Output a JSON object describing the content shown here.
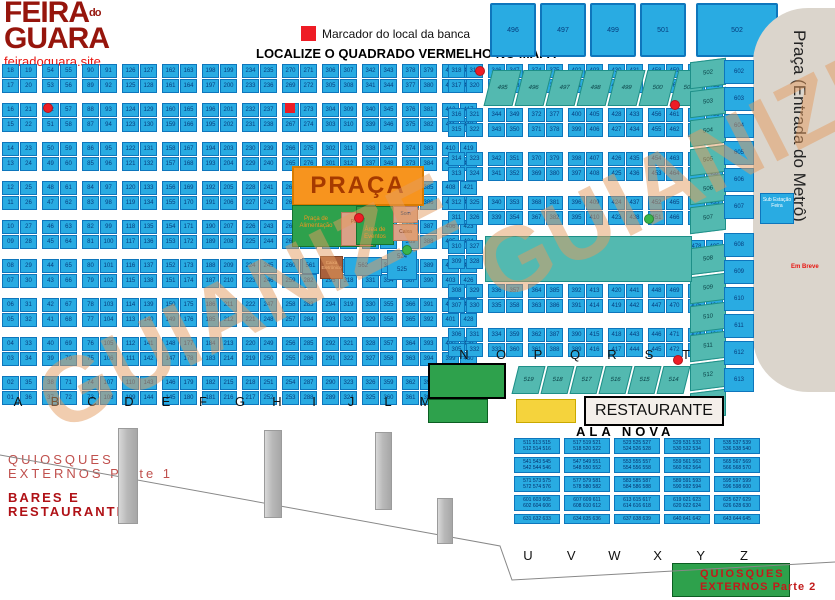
{
  "logo": {
    "line1": "FEIRA",
    "mid": "do",
    "line2": "GUARA",
    "site": "feiradoguara.site"
  },
  "legend": {
    "marker_label": "Marcador do local da banca",
    "headline": "LOCALIZE O QUADRADO VERMELHO NO MAPA"
  },
  "watermark": {
    "text": "GUIANIZE"
  },
  "colors": {
    "accent_red": "#EE1C25",
    "cell_blue": "#29ABE2",
    "teal": "#53B9B0",
    "orange": "#F7941E",
    "green": "#2EA14C",
    "yellow": "#F5D33C",
    "logo_red": "#96150C",
    "metro_gray": "#DBD5CC"
  },
  "top_boxes": [
    "496",
    "497",
    "499",
    "501",
    "502"
  ],
  "left_grid": {
    "columns": [
      {
        "letter": "A",
        "left": [
          18,
          17,
          16,
          15,
          14,
          13,
          12,
          11,
          10,
          9,
          8,
          7,
          6,
          5,
          4,
          3,
          2,
          1
        ],
        "right": [
          19,
          20,
          21,
          22,
          23,
          24,
          25,
          26,
          27,
          28,
          29,
          30,
          31,
          32,
          33,
          34,
          35,
          36
        ]
      },
      {
        "letter": "B",
        "left": [
          54,
          53,
          52,
          51,
          50,
          49,
          48,
          47,
          46,
          45,
          44,
          43,
          42,
          41,
          40,
          39,
          38,
          37
        ],
        "right": [
          55,
          56,
          57,
          58,
          59,
          60,
          61,
          62,
          63,
          64,
          65,
          66,
          67,
          68,
          69,
          70,
          71,
          72
        ]
      },
      {
        "letter": "C",
        "left": [
          90,
          89,
          88,
          87,
          86,
          85,
          84,
          83,
          82,
          81,
          80,
          79,
          78,
          77,
          76,
          75,
          74,
          73
        ],
        "right": [
          91,
          92,
          93,
          94,
          95,
          96,
          97,
          98,
          99,
          100,
          101,
          102,
          103,
          104,
          105,
          106,
          107,
          108
        ]
      },
      {
        "letter": "D",
        "left": [
          126,
          125,
          124,
          123,
          122,
          121,
          120,
          119,
          118,
          117,
          116,
          115,
          114,
          113,
          112,
          111,
          110,
          109
        ],
        "right": [
          127,
          128,
          129,
          130,
          131,
          132,
          133,
          134,
          135,
          136,
          137,
          138,
          139,
          140,
          141,
          142,
          143,
          144
        ]
      },
      {
        "letter": "E",
        "left": [
          162,
          161,
          160,
          159,
          158,
          157,
          156,
          155,
          154,
          153,
          152,
          151,
          150,
          149,
          148,
          147,
          146,
          145
        ],
        "right": [
          163,
          164,
          165,
          166,
          167,
          168,
          169,
          170,
          171,
          172,
          173,
          174,
          175,
          176,
          177,
          178,
          179,
          180
        ]
      },
      {
        "letter": "F",
        "left": [
          198,
          197,
          196,
          195,
          194,
          193,
          192,
          191,
          190,
          189,
          188,
          187,
          186,
          185,
          184,
          183,
          182,
          181
        ],
        "right": [
          199,
          200,
          201,
          202,
          203,
          204,
          205,
          206,
          207,
          208,
          209,
          210,
          211,
          212,
          213,
          214,
          215,
          216
        ]
      },
      {
        "letter": "G",
        "left": [
          234,
          233,
          232,
          231,
          230,
          229,
          228,
          227,
          226,
          225,
          224,
          223,
          222,
          221,
          220,
          219,
          218,
          217
        ],
        "right": [
          235,
          236,
          237,
          238,
          239,
          240,
          241,
          242,
          243,
          244,
          245,
          246,
          247,
          248,
          249,
          250,
          251,
          252
        ]
      },
      {
        "letter": "H",
        "left": [
          270,
          269,
          268,
          267,
          266,
          265,
          264,
          263,
          262,
          261,
          260,
          259,
          258,
          257,
          256,
          255,
          254,
          253
        ],
        "right": [
          271,
          272,
          273,
          274,
          275,
          276,
          277,
          278,
          279,
          280,
          281,
          282,
          283,
          284,
          285,
          286,
          287,
          288
        ]
      },
      {
        "letter": "I",
        "left": [
          306,
          305,
          304,
          303,
          302,
          301,
          300,
          299,
          298,
          297,
          296,
          295,
          294,
          293,
          292,
          291,
          290,
          289
        ],
        "right": [
          307,
          308,
          309,
          310,
          311,
          312,
          313,
          314,
          315,
          316,
          317,
          318,
          319,
          320,
          321,
          322,
          323,
          324
        ]
      },
      {
        "letter": "J",
        "left": [
          342,
          341,
          340,
          339,
          338,
          337,
          336,
          335,
          334,
          333,
          332,
          331,
          330,
          329,
          328,
          327,
          326,
          325
        ],
        "right": [
          343,
          344,
          345,
          346,
          347,
          348,
          349,
          350,
          351,
          352,
          353,
          354,
          355,
          356,
          357,
          358,
          359,
          360
        ]
      },
      {
        "letter": "L",
        "left": [
          378,
          377,
          376,
          375,
          374,
          373,
          372,
          371,
          370,
          369,
          368,
          367,
          366,
          365,
          364,
          363,
          362,
          361
        ],
        "right": [
          379,
          380,
          381,
          382,
          383,
          384,
          385,
          386,
          387,
          388,
          389,
          390,
          391,
          392,
          393,
          394,
          395,
          396
        ]
      },
      {
        "letter": "M",
        "left": [
          414,
          413,
          412,
          411,
          410,
          409,
          408,
          407,
          406,
          405,
          404,
          403,
          402,
          401,
          400,
          399,
          398,
          397
        ],
        "right": [
          415,
          416,
          417,
          418,
          419,
          420,
          421,
          422,
          423,
          424,
          425,
          426,
          427,
          428,
          429,
          430,
          431,
          432
        ]
      }
    ]
  },
  "right_grid": {
    "columns": [
      {
        "letter": "N",
        "left": [
          318,
          317,
          316,
          315,
          314,
          313,
          312,
          311,
          310,
          309,
          308,
          307,
          306,
          305
        ],
        "right": [
          319,
          320,
          321,
          322,
          323,
          324,
          325,
          326,
          327,
          328,
          329,
          330,
          331,
          332
        ]
      },
      {
        "letter": "O",
        "left": [
          346,
          345,
          344,
          343,
          342,
          341,
          340,
          339,
          338,
          337,
          336,
          335,
          334,
          333
        ],
        "right": [
          347,
          348,
          349,
          350,
          351,
          352,
          353,
          354,
          355,
          356,
          357,
          358,
          359,
          360
        ]
      },
      {
        "letter": "P",
        "left": [
          374,
          373,
          372,
          371,
          370,
          369,
          368,
          367,
          366,
          365,
          364,
          363,
          362,
          361
        ],
        "right": [
          375,
          376,
          377,
          378,
          379,
          380,
          381,
          382,
          383,
          384,
          385,
          386,
          387,
          388
        ]
      },
      {
        "letter": "Q",
        "left": [
          402,
          401,
          400,
          399,
          398,
          397,
          396,
          395,
          394,
          393,
          392,
          391,
          390,
          389
        ],
        "right": [
          403,
          404,
          405,
          406,
          407,
          408,
          409,
          410,
          411,
          412,
          413,
          414,
          415,
          416
        ]
      },
      {
        "letter": "R",
        "left": [
          430,
          429,
          428,
          427,
          426,
          425,
          424,
          423,
          422,
          421,
          420,
          419,
          418,
          417
        ],
        "right": [
          431,
          432,
          433,
          434,
          435,
          436,
          437,
          438,
          439,
          440,
          441,
          442,
          443,
          444
        ]
      },
      {
        "letter": "S",
        "left": [
          458,
          457,
          456,
          455,
          454,
          453,
          452,
          451,
          450,
          449,
          448,
          447,
          446,
          445
        ],
        "right": [
          459,
          460,
          461,
          462,
          463,
          464,
          465,
          466,
          467,
          468,
          469,
          470,
          471,
          472
        ]
      },
      {
        "letter": "T",
        "left": [
          486,
          485,
          484,
          483,
          482,
          481,
          480,
          479,
          478,
          477,
          476,
          475,
          474,
          473
        ],
        "right": [
          487,
          488,
          489,
          490,
          491,
          492,
          493,
          494,
          495,
          496,
          497,
          498,
          499,
          500
        ]
      }
    ]
  },
  "diag_top_strip": [
    "495",
    "496",
    "497",
    "498",
    "499",
    "500",
    "501"
  ],
  "diag_bottom_strip": [
    "519",
    "518",
    "517",
    "516",
    "515",
    "514"
  ],
  "side_teal_column": [
    "502",
    "503",
    "504",
    "505",
    "506",
    "507",
    "508",
    "509",
    "510",
    "511",
    "512",
    "513"
  ],
  "side_blue_column": [
    "602",
    "603",
    "604",
    "605",
    "606",
    "607",
    "608",
    "609",
    "610",
    "611",
    "612",
    "613"
  ],
  "praca": {
    "title": "PRAÇA",
    "food_court": "Praça de Alimentação",
    "stage": "Palco",
    "events": "Área de Eventos",
    "sound": "Som",
    "cash": "Caixa",
    "atm": "Caixa Eletrônico",
    "cell_a": "561",
    "cell_b": "562",
    "cell_c": "524",
    "cell_d": "525"
  },
  "metro": {
    "label": "Praça (Entrada do Metrô)",
    "soon": "Em Breve",
    "substation": "Sub Estação Feira"
  },
  "sections": {
    "restaurante": "RESTAURANTE",
    "ala_nova": "ALA NOVA",
    "quiosques1_line1": "QUIOSQUES",
    "quiosques1_line2": "EXTERNOS Parte 1",
    "bares_line1": "BARES E",
    "bares_line2": "RESTAURANTES",
    "quiosques2_line1": "QUIOSQUES",
    "quiosques2_line2": "EXTERNOS Parte 2"
  },
  "ala_nova": {
    "rows": [
      [
        [
          511,
          512,
          513,
          514,
          515,
          516
        ],
        [
          517,
          518,
          519,
          520,
          521,
          522
        ],
        [
          523,
          524,
          525,
          526,
          527,
          528
        ],
        [
          529,
          530,
          531,
          532,
          533,
          534
        ],
        [
          535,
          536,
          537,
          538,
          539,
          540
        ]
      ],
      [
        [
          541,
          542,
          543,
          544,
          545,
          546
        ],
        [
          547,
          548,
          549,
          550,
          551,
          552
        ],
        [
          553,
          554,
          555,
          556,
          557,
          558
        ],
        [
          559,
          560,
          561,
          562,
          563,
          564
        ],
        [
          565,
          566,
          567,
          568,
          569,
          570
        ]
      ],
      [
        [
          571,
          572,
          573,
          574,
          575,
          576
        ],
        [
          577,
          578,
          579,
          580,
          581,
          582
        ],
        [
          583,
          584,
          585,
          586,
          587,
          588
        ],
        [
          589,
          590,
          591,
          592,
          593,
          594
        ],
        [
          595,
          596,
          597,
          598,
          599,
          600
        ]
      ],
      [
        [
          601,
          602,
          603,
          604,
          605,
          606
        ],
        [
          607,
          608,
          609,
          610,
          611,
          612
        ],
        [
          613,
          614,
          615,
          616,
          617,
          618
        ],
        [
          619,
          620,
          621,
          622,
          623,
          624
        ],
        [
          625,
          626,
          627,
          628,
          629,
          630
        ]
      ],
      [
        [
          631,
          632,
          633
        ],
        [
          634,
          635,
          636
        ],
        [
          637,
          638,
          639
        ],
        [
          640,
          641,
          642
        ],
        [
          643,
          644,
          645
        ]
      ]
    ]
  },
  "letters_left": [
    "A",
    "B",
    "C",
    "D",
    "E",
    "F",
    "G",
    "H",
    "I",
    "J",
    "L",
    "M"
  ],
  "letters_mid": [
    "N",
    "O",
    "P",
    "Q",
    "R",
    "S",
    "T"
  ],
  "letters_bottom": [
    "U",
    "V",
    "W",
    "X",
    "Y",
    "Z"
  ],
  "markers": [
    {
      "x": 43,
      "y": 103,
      "color": "#EE1C25"
    },
    {
      "x": 475,
      "y": 66,
      "color": "#EE1C25"
    },
    {
      "x": 670,
      "y": 100,
      "color": "#EE1C25"
    },
    {
      "x": 673,
      "y": 355,
      "color": "#EE1C25"
    },
    {
      "x": 354,
      "y": 213,
      "color": "#EE1C25"
    },
    {
      "x": 402,
      "y": 245,
      "color": "#39B54A"
    },
    {
      "x": 644,
      "y": 214,
      "color": "#39B54A"
    }
  ],
  "pillars": [
    {
      "x": 118,
      "y": 428,
      "w": 18,
      "h": 94
    },
    {
      "x": 264,
      "y": 430,
      "w": 16,
      "h": 86
    },
    {
      "x": 375,
      "y": 432,
      "w": 15,
      "h": 76
    },
    {
      "x": 437,
      "y": 498,
      "w": 14,
      "h": 44
    }
  ],
  "banca_marker": {
    "x": 285,
    "y": 103
  }
}
